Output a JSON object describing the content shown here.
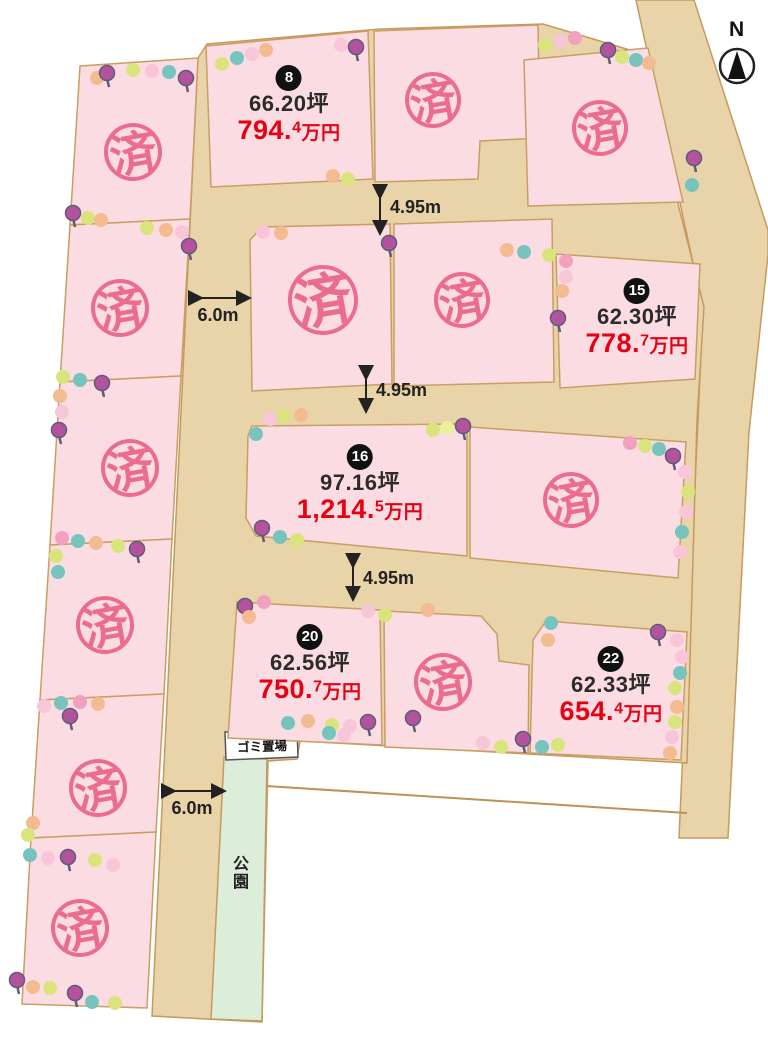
{
  "labels": {
    "sold": "済",
    "north": "N",
    "park": "公園",
    "garbage": "ゴミ置場"
  },
  "dimensions": {
    "road1": "4.95m",
    "road2": "4.95m",
    "road3": "4.95m",
    "width_top": "6.0m",
    "width_bottom": "6.0m"
  },
  "plots": [
    {
      "number": "8",
      "area": "66.20坪",
      "price_main": "794.",
      "price_sup": "4",
      "price_unit": "万円"
    },
    {
      "number": "15",
      "area": "62.30坪",
      "price_main": "778.",
      "price_sup": "7",
      "price_unit": "万円"
    },
    {
      "number": "16",
      "area": "97.16坪",
      "price_main": "1,214.",
      "price_sup": "5",
      "price_unit": "万円"
    },
    {
      "number": "20",
      "area": "62.56坪",
      "price_main": "750.",
      "price_sup": "7",
      "price_unit": "万円"
    },
    {
      "number": "22",
      "area": "62.33坪",
      "price_main": "654.",
      "price_sup": "4",
      "price_unit": "万円"
    }
  ],
  "colors": {
    "road": "#e9d4aa",
    "road_stroke": "#c49a5e",
    "plot_pink": "#fbdce3",
    "sold_stamp": "#ec6c8e",
    "price_red": "#e60012",
    "park_green": "#dcedda",
    "badge_black": "#111111"
  }
}
